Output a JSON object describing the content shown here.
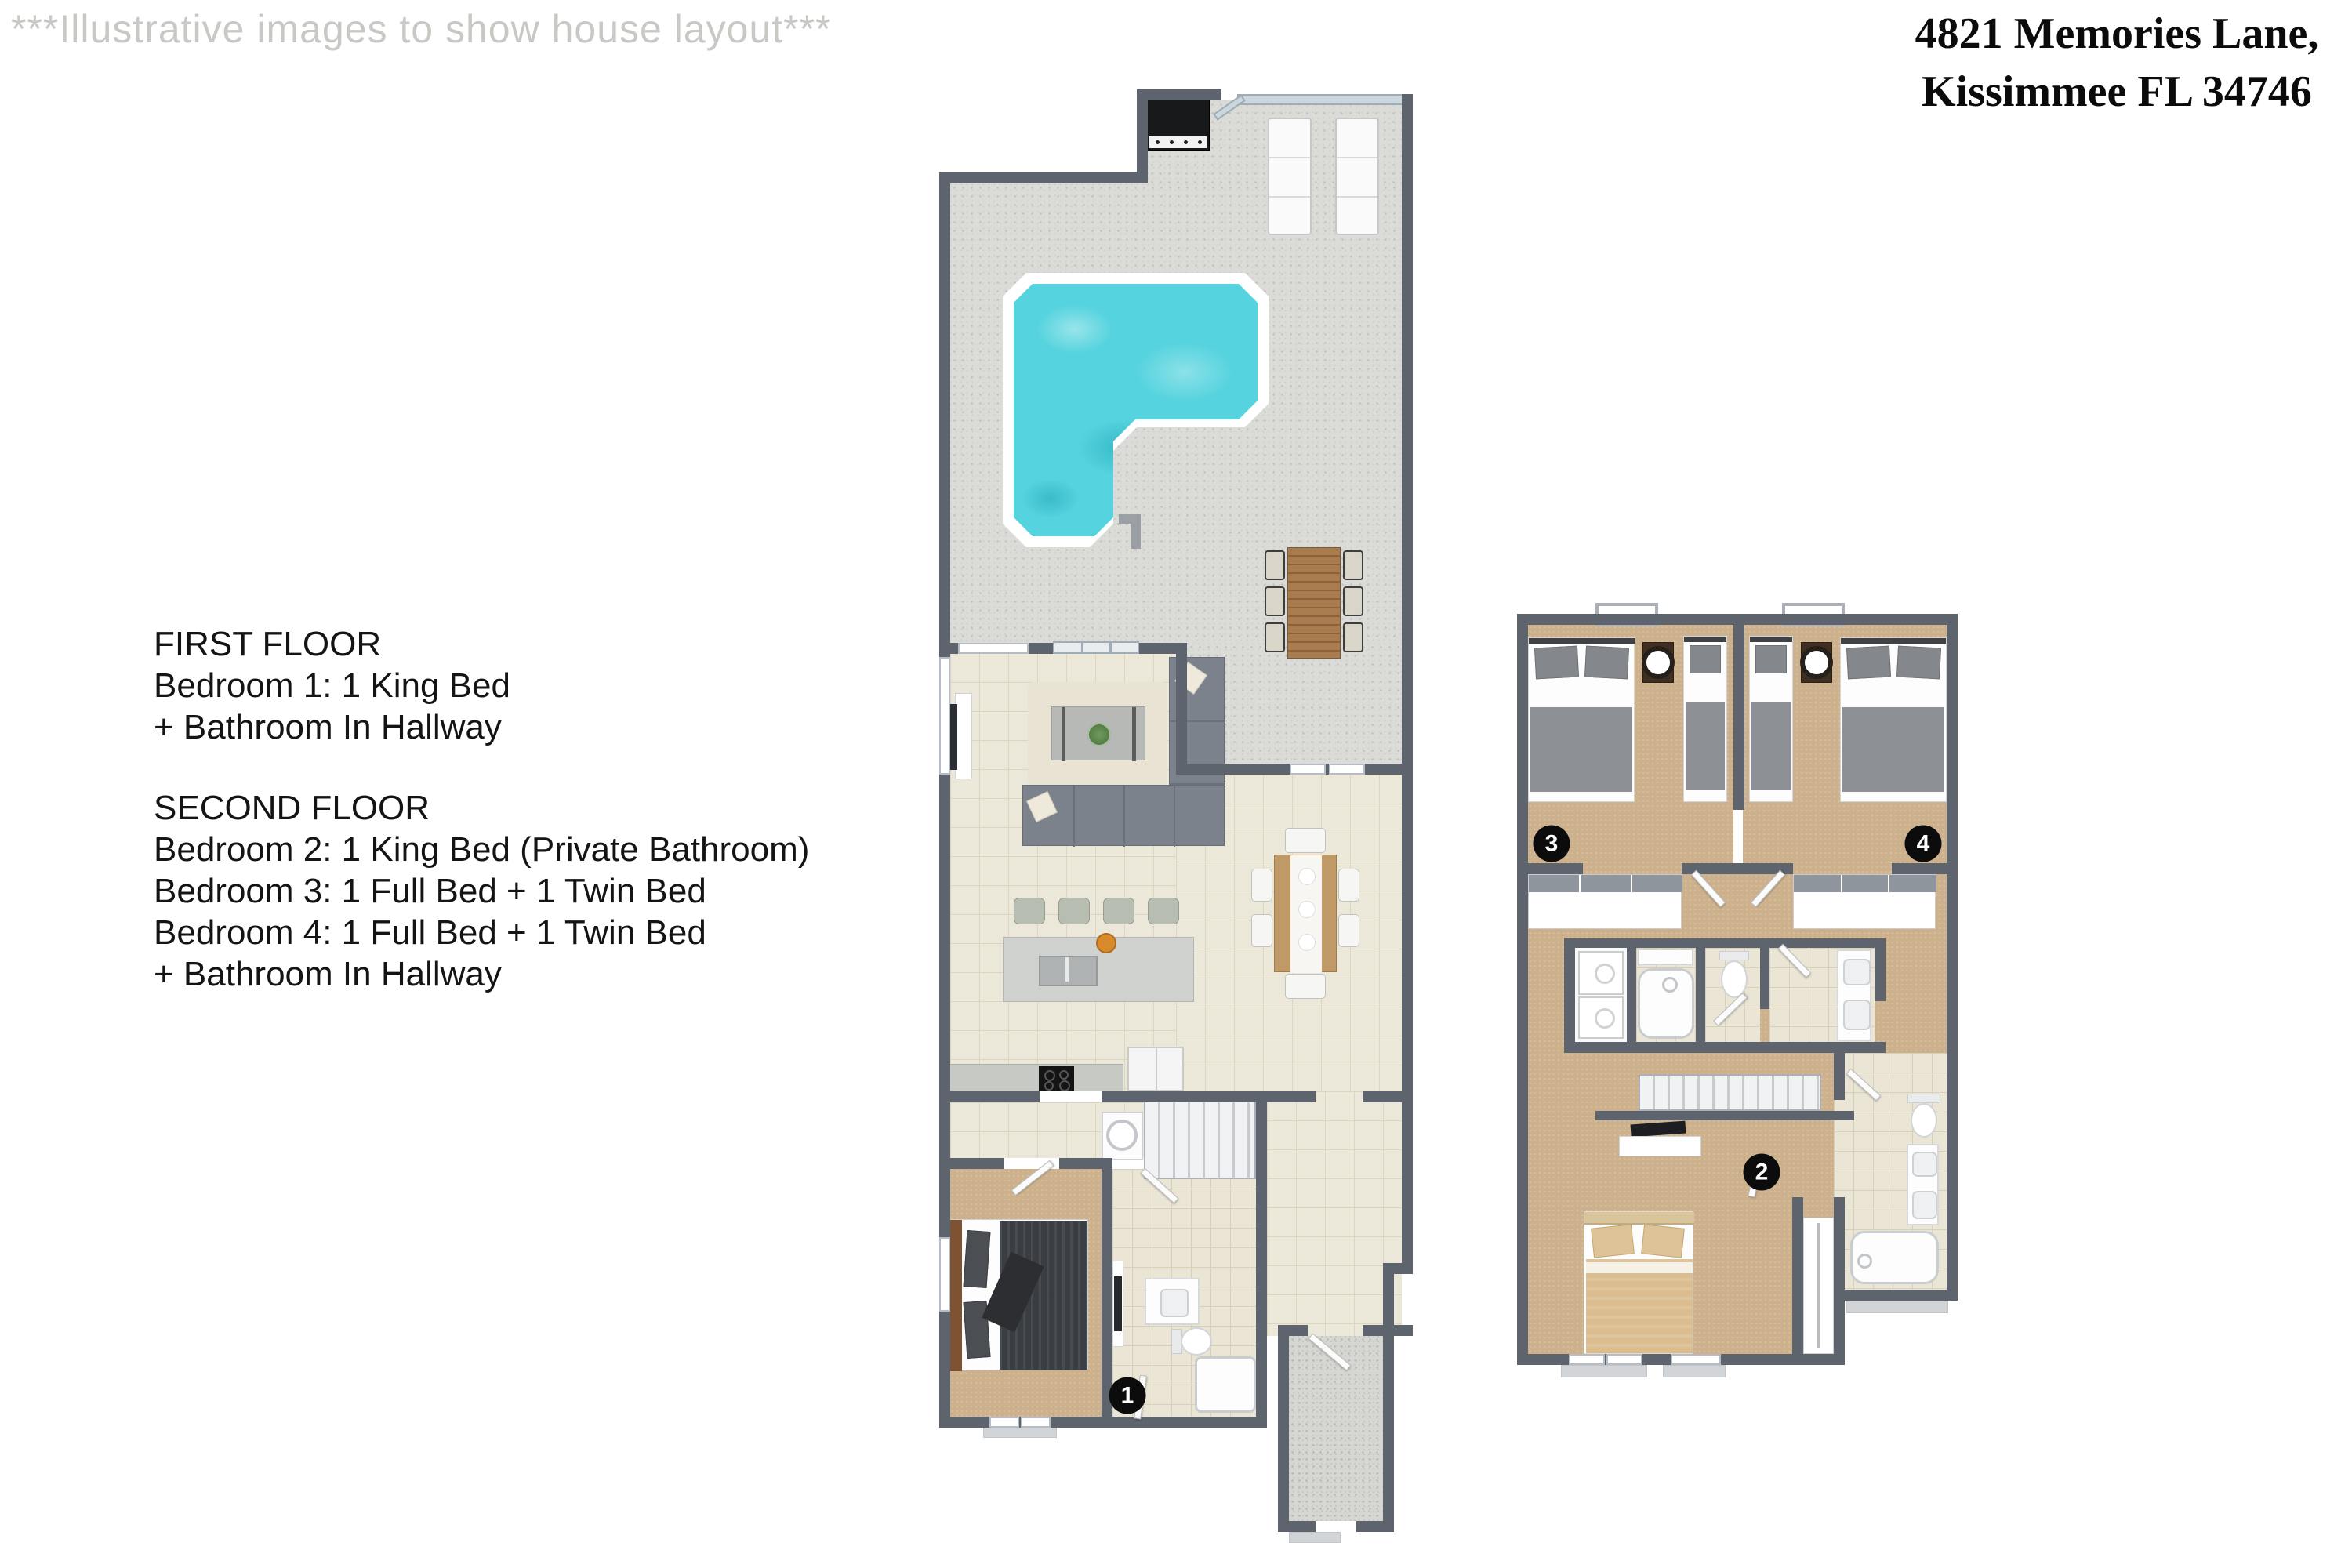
{
  "watermark": "***Illustrative images to show house layout***",
  "address": {
    "line1": "4821 Memories Lane,",
    "line2": "Kissimmee FL 34746"
  },
  "info": {
    "first": {
      "title": "FIRST FLOOR",
      "lines": [
        "Bedroom 1: 1 King Bed",
        "+ Bathroom In Hallway"
      ]
    },
    "second": {
      "title": "SECOND FLOOR",
      "lines": [
        "Bedroom 2: 1 King Bed (Private Bathroom)",
        "Bedroom 3: 1 Full Bed + 1 Twin Bed",
        "Bedroom 4: 1 Full Bed + 1 Twin Bed",
        "+ Bathroom In Hallway"
      ]
    }
  },
  "markers": {
    "bedroom1": "1",
    "bedroom2": "2",
    "bedroom3": "3",
    "bedroom4": "4"
  },
  "colors": {
    "wall": "#5d646d",
    "pool_water": "#55d3de",
    "pool_rim": "#ffffff",
    "patio": "#dbdcd8",
    "interior_tile": "#ece8d9",
    "carpet": "#cdb18c",
    "marker_bg": "#0c0c0c",
    "wood": "#a97c4f"
  }
}
